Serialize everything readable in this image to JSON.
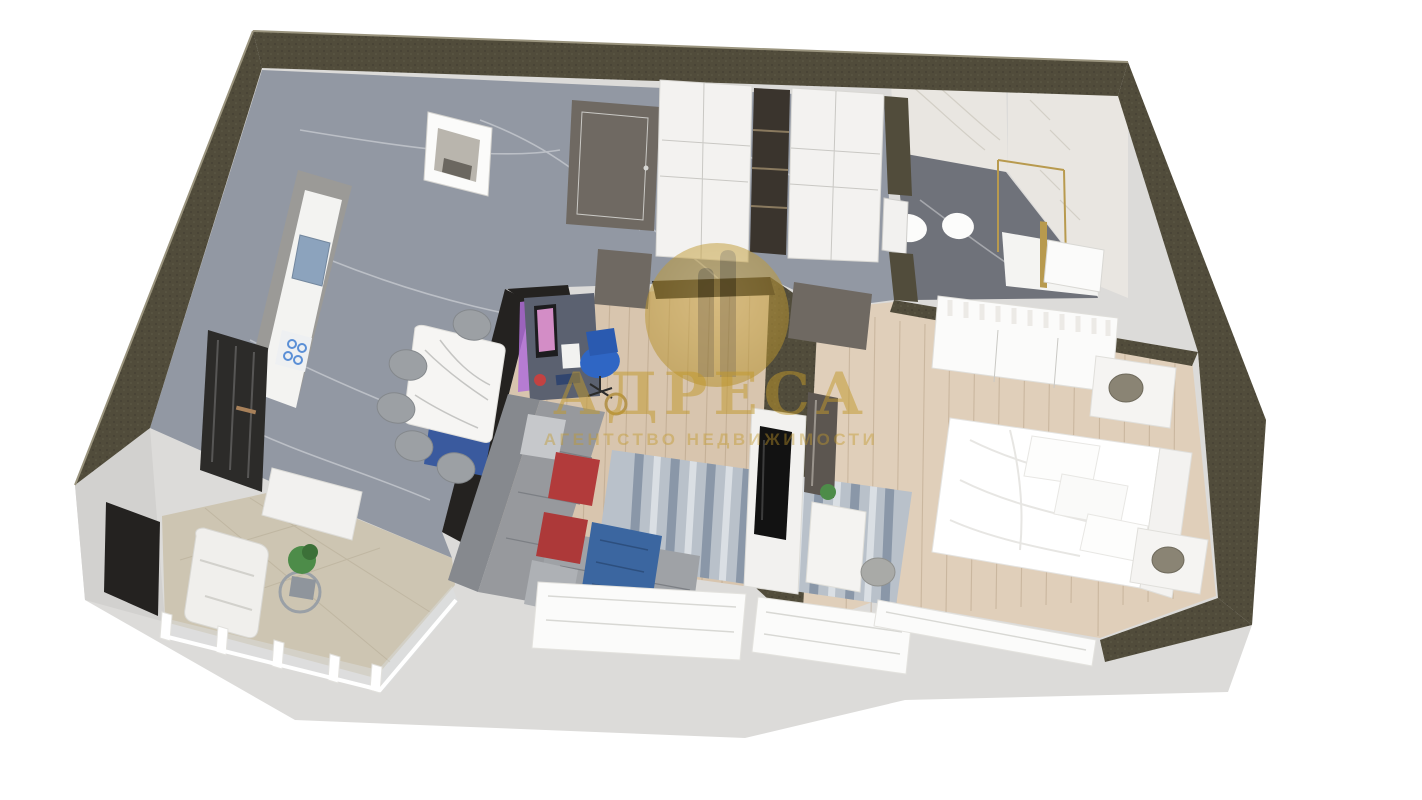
{
  "watermark": {
    "title": "АДРЕСА",
    "subtitle": "АГЕНТСТВО НЕДВИЖИМОСТИ",
    "logo": "columns-circle-logo"
  },
  "colors": {
    "background": "#ffffff",
    "wall-top": "#514c3b",
    "wall-top-light": "#9a947e",
    "wall-dark": "#242220",
    "outer-face": "#dcdbd9",
    "outer-face-bright": "#f2f2f0",
    "floor-marble": "#9298a3",
    "floor-marble-dark": "#7b808b",
    "floor-wood": "#d8c5ae",
    "floor-wood-bedroom": "#e0cfba",
    "floor-tile-balcony": "#cdc5b2",
    "bath-floor": "#6f727a",
    "bath-marble": "#e9e6e1",
    "gold": "#c2992b",
    "sofa": "#97999d",
    "pillow-red": "#b23b3b",
    "throw-blue": "#3b66a0",
    "chair-blue": "#2f66c4",
    "rug-base": "#b9c1ca",
    "rug-streak": "#64748c",
    "plant-green": "#4d8c49",
    "door-leaf": "#6f6962",
    "furniture-white": "#f3f2f0"
  }
}
